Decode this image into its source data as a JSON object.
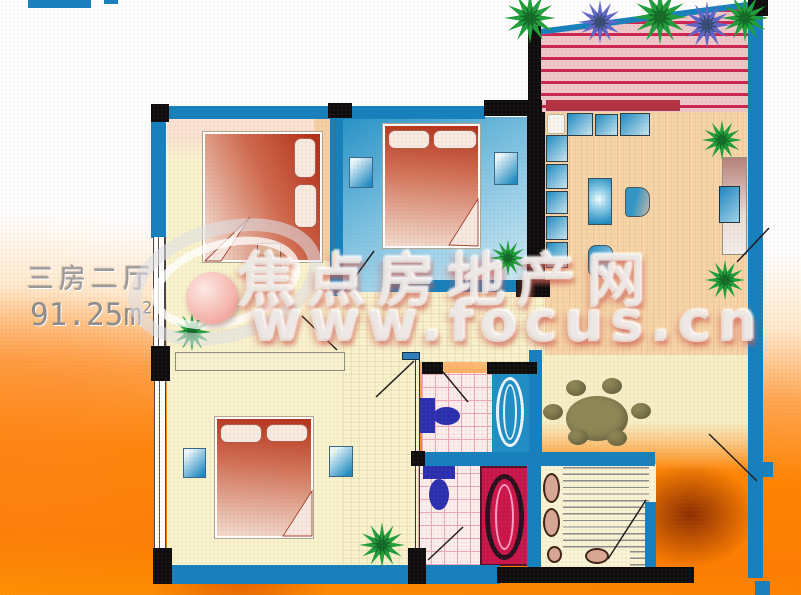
{
  "title_block": {
    "layout_type": "三房二厅",
    "area": "91.25m",
    "area_sup": "2"
  },
  "watermark": {
    "brand_cn": "焦点房地产网",
    "brand_url": "www.focus.cn"
  },
  "colors": {
    "wall_blue": "#1480bd",
    "wall_black": "#0d0d0d",
    "floor_cream": "#f8f3cd",
    "floor_peach": "#f6d5a8",
    "floor_dining": "#f6efc6",
    "bedroom_blue_a": "#2593c8",
    "bedroom_blue_b": "#d5edf7",
    "bed_dark": "#b23018",
    "bed_light": "#f2dccf",
    "pillow": "#f6eae1",
    "terrace_pink": "#eec5c8",
    "terrace_stripe": "#cc2450",
    "tile_bg": "#faedeb",
    "tile_line": "#eba8b6",
    "bath_blue": "#1e8ec6",
    "bath_red": "#c9164a",
    "toilet_blue": "#2a2fb0",
    "olive": "#8d8756",
    "sofa_a": "#1e8cc2",
    "sofa_b": "#c8e6f2",
    "plant_green": "#1f9e3c",
    "plant_purple": "#5f66c9",
    "bg_orange": "#ff8400",
    "title_grey": "#9b9b9b"
  }
}
